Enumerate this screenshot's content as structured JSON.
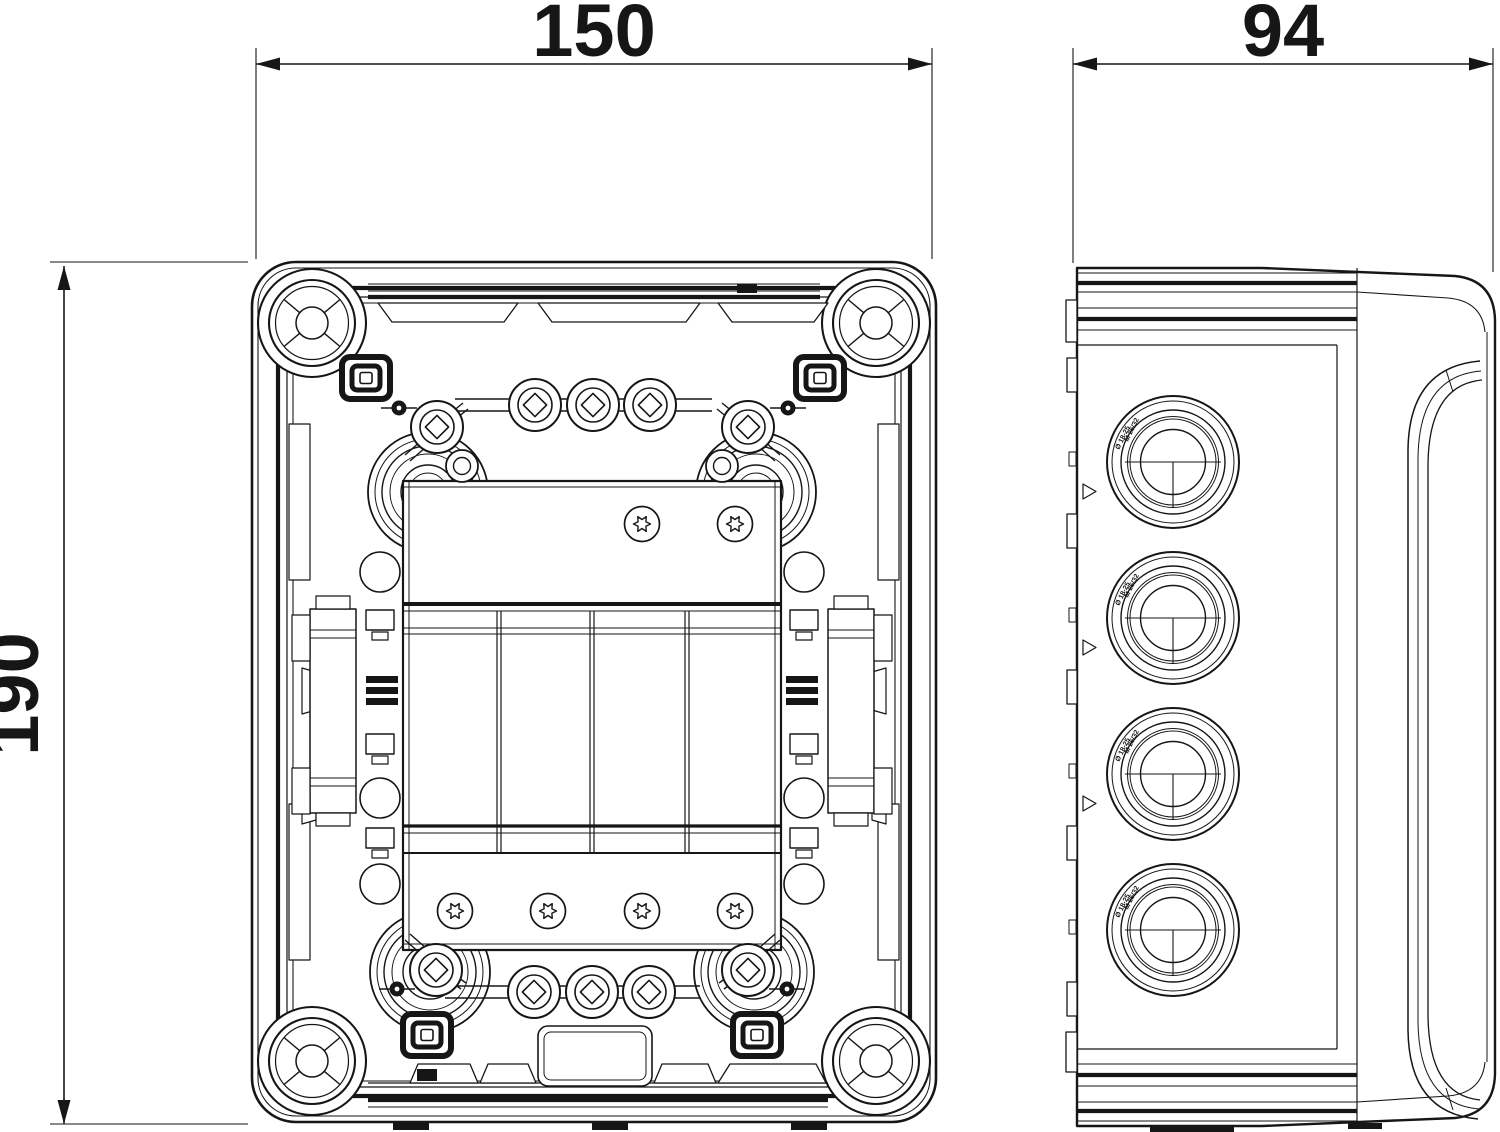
{
  "page": {
    "background": "#ffffff",
    "ink": "#161616"
  },
  "dimensions": {
    "front_width": "150",
    "front_height": "190",
    "side_depth": "94"
  },
  "gland_marking": {
    "line1": "Ø 18-25",
    "line2": "M 25/32"
  }
}
